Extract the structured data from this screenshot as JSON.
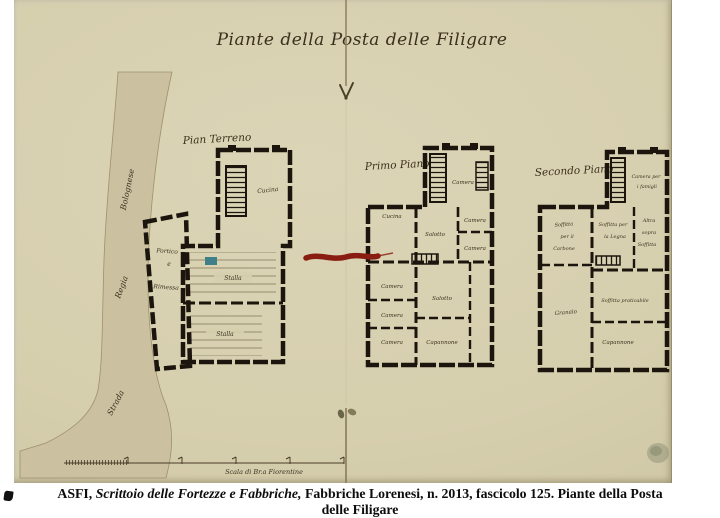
{
  "figure": {
    "title": "Piante della Posta delle Filigare",
    "plans": [
      {
        "label": "Pian Terreno"
      },
      {
        "label": "Primo Piano"
      },
      {
        "label": "Secondo Piano"
      }
    ],
    "rooms": {
      "cucina": "Cucina",
      "stalla": "Stalla",
      "portico": "Portico",
      "e": "e",
      "rimessa": "Rimessa",
      "salotto": "Salotto",
      "camera": "Camera",
      "capannone": "Capannone",
      "camera_famigli_l1": "Camera per",
      "camera_famigli_l2": "i famigli",
      "soffitta_carbone_l1": "Soffitta",
      "soffitta_carbone_l2": "per il",
      "soffitta_carbone_l3": "Carbone",
      "soffitta_legna_l1": "Soffitta per",
      "soffitta_legna_l2": "la Legna",
      "altra_soffitta_l1": "Altra",
      "altra_soffitta_l2": "sopra",
      "altra_soffitta_l3": "Soffitta",
      "granaio": "Granaio",
      "soffitta_praticabile": "Soffitta praticabile"
    },
    "road": {
      "strada": "Strada",
      "regia": "Regia",
      "bolognese": "Bolognese"
    },
    "scale_label": "Scala di Br.a Fiorentine"
  },
  "caption": {
    "asfi": "ASFI, ",
    "italic": "Scrittoio delle Fortezze e Fabbriche,",
    "rest": " Fabbriche Lorenesi, n. 2013, fascicolo 125. Piante della Posta",
    "line2": "delle Filigare"
  },
  "colors": {
    "paper": "#d6cfae",
    "road": "#cbc0a0",
    "wall_ink": "#1c150e",
    "handwriting_ink": "#3c301d",
    "red_mark": "#8a1d12",
    "stamp": "#878c72"
  }
}
